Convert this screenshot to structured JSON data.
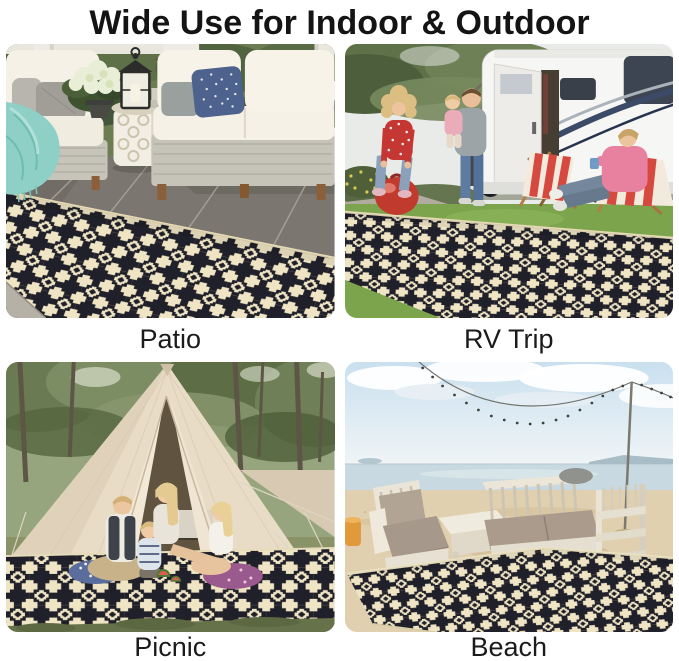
{
  "title": "Wide Use for Indoor & Outdoor",
  "scenes": [
    {
      "id": "patio",
      "label": "Patio"
    },
    {
      "id": "rv-trip",
      "label": "RV Trip"
    },
    {
      "id": "picnic",
      "label": "Picnic"
    },
    {
      "id": "beach",
      "label": "Beach"
    }
  ],
  "rug": {
    "style": "black and cream diamond lattice outdoor rug",
    "black": "#20202a",
    "cream": "#efe5c4"
  },
  "colors": {
    "background": "#ffffff",
    "title_text": "#141414",
    "caption_text": "#1b1b1b"
  }
}
